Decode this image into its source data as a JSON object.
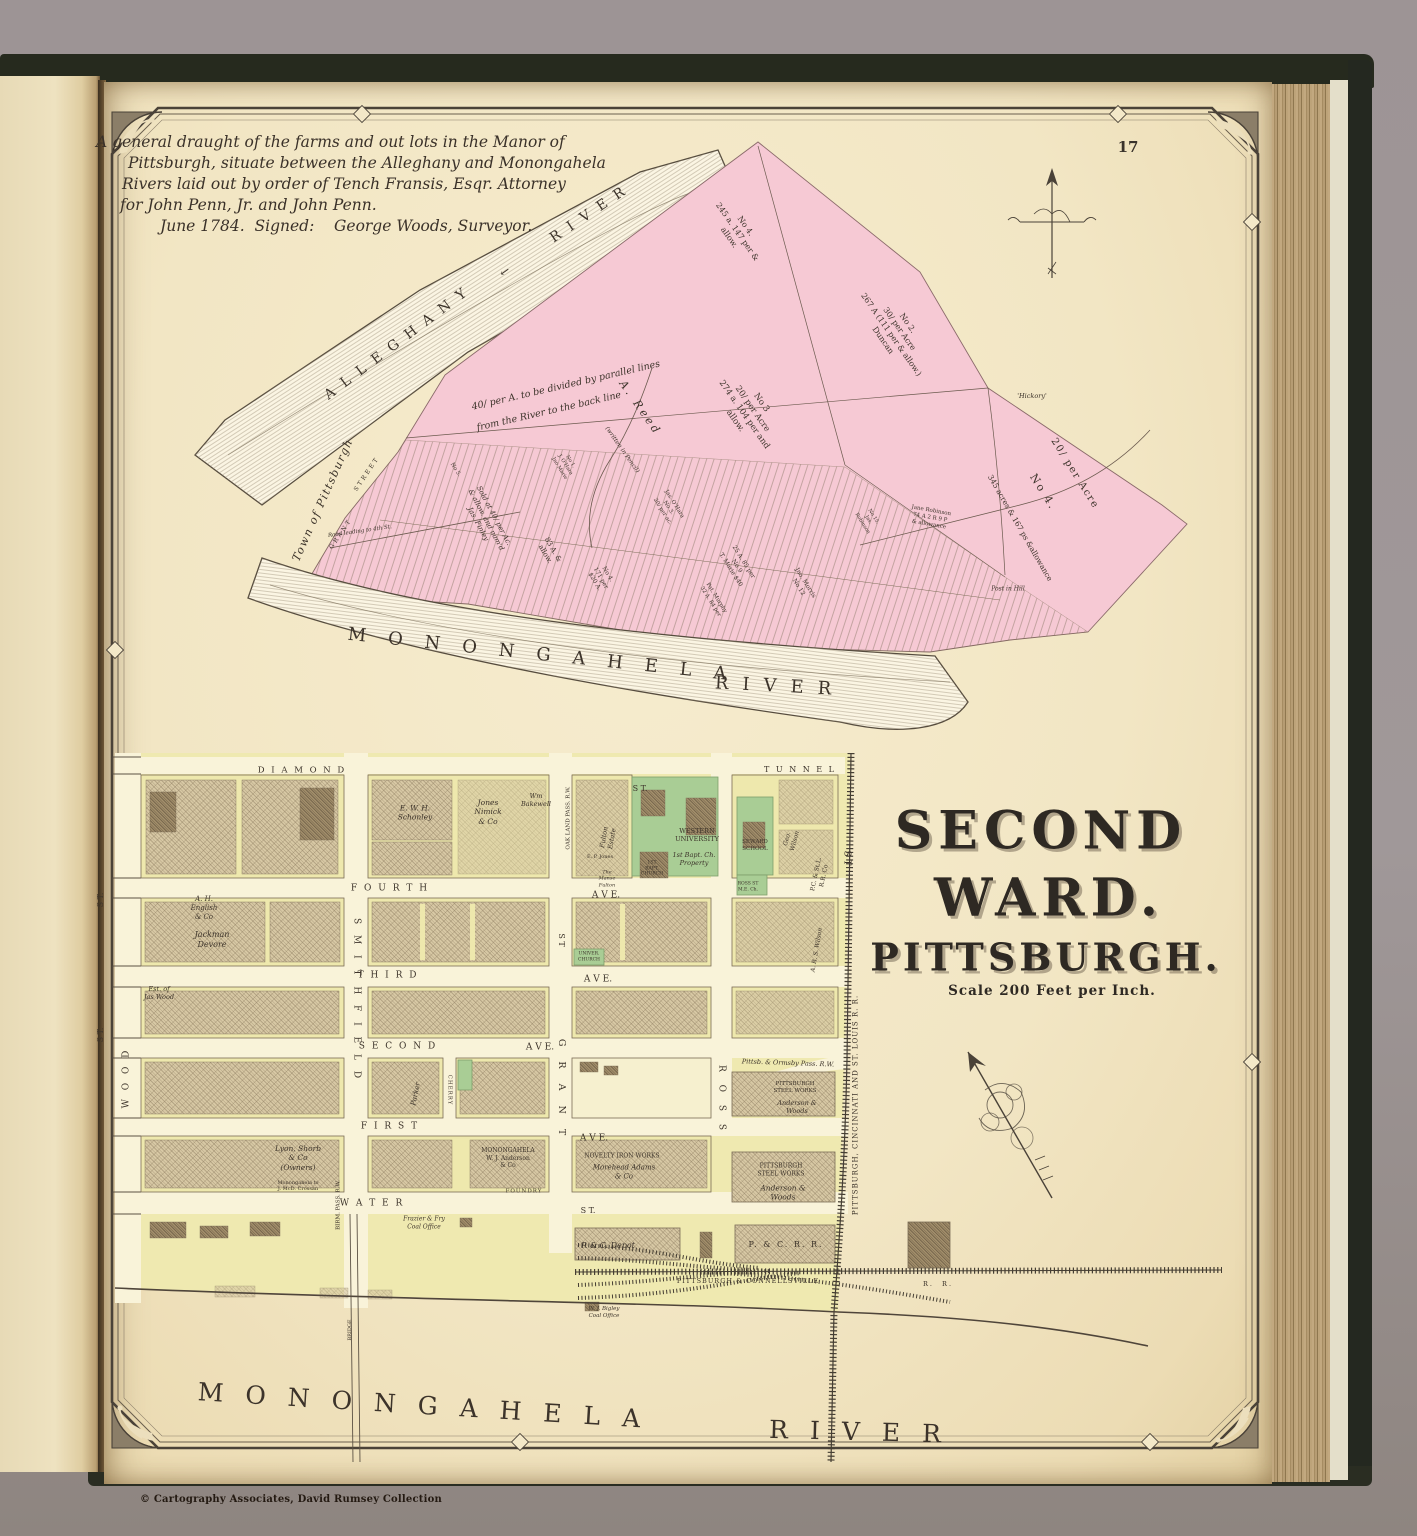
{
  "page": {
    "number": "17",
    "copyright": "© Cartography Associates, David Rumsey Collection"
  },
  "palette": {
    "manor_pink": "#f6c9d4",
    "block_yellow": "#efe9b0",
    "school_green": "#a9cd95",
    "paper": "#f2e6c4"
  },
  "upper_map": {
    "title_lines": [
      "A general draught of the farms and out lots in the Manor of",
      "Pittsburgh, situate between the Alleghany and Monongahela",
      "Rivers laid out by order of Tench Fransis, Esqr. Attorney",
      "for John Penn, Jr. and John Penn.",
      "June 1784.  Signed:    George Woods, Surveyor."
    ],
    "labels": [
      {
        "id": "alleghany-name",
        "t": "ALLEGHANY",
        "x": 400,
        "y": 342,
        "r": -37,
        "fs": 14,
        "ls": 10
      },
      {
        "id": "alleghany-river-word",
        "t": "RIVER",
        "x": 592,
        "y": 213,
        "r": -34,
        "fs": 14,
        "ls": 10
      },
      {
        "id": "flow-arrow-icon",
        "t": "←",
        "x": 505,
        "y": 272,
        "r": -36,
        "fs": 12
      },
      {
        "id": "lot-no4-north",
        "t": "No 4.\n245 a. 147 per &\nallow.",
        "x": 737,
        "y": 232,
        "r": 55,
        "fs": 8
      },
      {
        "id": "lot-no2",
        "t": "No 2.\n30/ per Acre\n267 A (111 per & allow.)\nDuncan",
        "x": 895,
        "y": 332,
        "r": 55,
        "fs": 8
      },
      {
        "id": "lot-no3",
        "t": "No 3\n20/ per Acre\n274 a. 104 per and\nallow.",
        "x": 748,
        "y": 412,
        "r": 55,
        "fs": 8.5
      },
      {
        "id": "reed-name",
        "t": "A. Reed",
        "x": 640,
        "y": 408,
        "r": 55,
        "fs": 11,
        "ls": 3,
        "c": "it"
      },
      {
        "id": "pencil-note",
        "t": "(written in Pencil)",
        "x": 622,
        "y": 450,
        "r": 55,
        "fs": 6,
        "c": "it"
      },
      {
        "id": "parallel-note-1",
        "t": "40/ per A. to be divided by parallel lines",
        "x": 566,
        "y": 386,
        "r": -13,
        "fs": 9.5,
        "c": "it"
      },
      {
        "id": "parallel-note-2",
        "t": "from the River to the back line",
        "x": 549,
        "y": 412,
        "r": -13,
        "fs": 9.5,
        "c": "it"
      },
      {
        "id": "town-of-pittsburgh",
        "t": "Town of Pittsburgh",
        "x": 323,
        "y": 500,
        "r": -66,
        "fs": 11,
        "ls": 1.5,
        "c": "it"
      },
      {
        "id": "grant-street-word",
        "t": "STREET",
        "x": 367,
        "y": 474,
        "r": -56,
        "fs": 6,
        "ls": 2.5
      },
      {
        "id": "grant-name",
        "t": "GRANT",
        "x": 341,
        "y": 534,
        "r": -56,
        "fs": 6,
        "ls": 2.5
      },
      {
        "id": "road-to-4th",
        "t": "Road leading to 4th St.",
        "x": 360,
        "y": 532,
        "r": -8,
        "fs": 5.5,
        "c": "it"
      },
      {
        "id": "sold-note",
        "t": "Sold at 40/ per Ac.\n& allow. and nam'd\nJas. Finley",
        "x": 486,
        "y": 520,
        "r": 62,
        "fs": 7,
        "c": "it"
      },
      {
        "id": "lot-83a",
        "t": "83 A. &\nallow.",
        "x": 549,
        "y": 552,
        "r": 60,
        "fs": 7
      },
      {
        "id": "lot-171per",
        "t": "No 4.\n171 per\n$20 A.",
        "x": 601,
        "y": 578,
        "r": 60,
        "fs": 6
      },
      {
        "id": "lot-no1-ohara",
        "t": "No 1.\nJ. O'Hara\nJno Marie",
        "x": 565,
        "y": 465,
        "r": 58,
        "fs": 5
      },
      {
        "id": "lot-no5",
        "t": "No 5.",
        "x": 455,
        "y": 470,
        "r": 58,
        "fs": 5.5
      },
      {
        "id": "lot-ohara",
        "t": "Jas. O'Hara\nNo 3.\n20/ per ac.",
        "x": 668,
        "y": 508,
        "r": 58,
        "fs": 5.5
      },
      {
        "id": "lot-marie",
        "t": "25 A. 85 per\nNo 9\nT. Marie $40",
        "x": 737,
        "y": 566,
        "r": 58,
        "fs": 6
      },
      {
        "id": "lot-morris",
        "t": "Jno. Morris\nNo 12",
        "x": 802,
        "y": 585,
        "r": 58,
        "fs": 6
      },
      {
        "id": "lot-murphy",
        "t": "Pat. Murphy\n32 A. 84 per",
        "x": 713,
        "y": 600,
        "r": 58,
        "fs": 5.5
      },
      {
        "id": "lot-no15",
        "t": "No 15.\nJas.\nRobinson",
        "x": 868,
        "y": 520,
        "r": 58,
        "fs": 5
      },
      {
        "id": "lot-jane-robinson",
        "t": "Jane Robinson\n74 A 2 R 9 P\n& allowance",
        "x": 930,
        "y": 518,
        "r": 10,
        "fs": 5.5
      },
      {
        "id": "post-in-hill",
        "t": "Post in Hill",
        "x": 1008,
        "y": 589,
        "fs": 6,
        "c": "it"
      },
      {
        "id": "hickory",
        "t": "'Hickory'",
        "x": 1032,
        "y": 396,
        "fs": 6.5,
        "c": "it"
      },
      {
        "id": "lot-no4e-rate",
        "t": "20/ per Acre",
        "x": 1074,
        "y": 474,
        "r": 58,
        "fs": 10,
        "ls": 1.5
      },
      {
        "id": "lot-no4e-no",
        "t": "No 4.",
        "x": 1043,
        "y": 492,
        "r": 58,
        "fs": 11,
        "ls": 2
      },
      {
        "id": "lot-no4e-acres",
        "t": "345 acres & 167 ps &allowance",
        "x": 1020,
        "y": 528,
        "r": 60,
        "fs": 7.5
      },
      {
        "id": "monongahela-upper",
        "t": "MONONGAHELA",
        "x": 548,
        "y": 656,
        "r": 6,
        "fs": 18,
        "ls": 22
      },
      {
        "id": "river-upper",
        "t": "RIVER",
        "x": 780,
        "y": 687,
        "r": 3,
        "fs": 18,
        "ls": 14
      }
    ]
  },
  "lower_map": {
    "title_line1": "SECOND",
    "title_line2": "WARD.",
    "title_line3": "PITTSBURGH.",
    "scale_note": "Scale 200 Feet per Inch.",
    "labels": [
      {
        "id": "street-diamond",
        "t": "D I A M O N D",
        "x": 302,
        "y": 771,
        "fs": 8.5,
        "ls": 2
      },
      {
        "id": "street-diamond-st",
        "t": "S T.",
        "x": 640,
        "y": 789,
        "fs": 8
      },
      {
        "id": "street-fourth",
        "t": "F O U R T H",
        "x": 390,
        "y": 889,
        "fs": 9,
        "ls": 2
      },
      {
        "id": "street-fourth-ave",
        "t": "A V E.",
        "x": 606,
        "y": 896,
        "fs": 9
      },
      {
        "id": "street-third",
        "t": "T H I R D",
        "x": 388,
        "y": 976,
        "fs": 9,
        "ls": 2
      },
      {
        "id": "street-third-ave",
        "t": "A V E.",
        "x": 598,
        "y": 980,
        "fs": 9
      },
      {
        "id": "street-second",
        "t": "S E C O N D",
        "x": 398,
        "y": 1047,
        "fs": 9,
        "ls": 2
      },
      {
        "id": "street-second-ave",
        "t": "A V E.",
        "x": 540,
        "y": 1048,
        "fs": 9
      },
      {
        "id": "street-first",
        "t": "F I R S T",
        "x": 390,
        "y": 1127,
        "fs": 9,
        "ls": 2
      },
      {
        "id": "street-first-ave",
        "t": "A V E.",
        "x": 594,
        "y": 1139,
        "fs": 9
      },
      {
        "id": "street-water",
        "t": "W A T E R",
        "x": 372,
        "y": 1204,
        "fs": 9,
        "ls": 2
      },
      {
        "id": "street-water-st",
        "t": "S T.",
        "x": 588,
        "y": 1211,
        "fs": 8
      },
      {
        "id": "street-wood",
        "t": "W O O D",
        "x": 127,
        "y": 1078,
        "r": -90,
        "fs": 9,
        "ls": 3
      },
      {
        "id": "street-wood-st",
        "t": "S T.",
        "x": 101,
        "y": 900,
        "r": -90,
        "fs": 8
      },
      {
        "id": "street-st-left",
        "t": "S T.",
        "x": 101,
        "y": 1035,
        "r": -90,
        "fs": 8
      },
      {
        "id": "street-smithfield",
        "t": "S M I T H F I E L D",
        "x": 356,
        "y": 1000,
        "r": 90,
        "fs": 9,
        "ls": 4
      },
      {
        "id": "street-grant",
        "t": "G R A N T",
        "x": 561,
        "y": 1090,
        "r": 90,
        "fs": 9.5,
        "ls": 6
      },
      {
        "id": "street-grant-st",
        "t": "S T",
        "x": 561,
        "y": 940,
        "r": 90,
        "fs": 8
      },
      {
        "id": "street-cherry",
        "t": "CHERRY",
        "x": 449,
        "y": 1090,
        "r": 90,
        "fs": 5.5,
        "ls": 1
      },
      {
        "id": "street-ross",
        "t": "R O S S",
        "x": 721,
        "y": 1100,
        "r": 90,
        "fs": 9,
        "ls": 5
      },
      {
        "id": "street-tunnel",
        "t": "T U N N E L",
        "x": 800,
        "y": 770,
        "fs": 8,
        "ls": 2
      },
      {
        "id": "street-st-rr",
        "t": "S T",
        "x": 846,
        "y": 858,
        "r": 90,
        "fs": 9
      },
      {
        "id": "rr-pcsl",
        "t": "PITTSBURGH, CINCINNATI AND ST. LOUIS R. R.",
        "x": 856,
        "y": 1105,
        "r": -90,
        "fs": 7,
        "ls": 1
      },
      {
        "id": "rr-pc-connellsville",
        "t": "PITTSBURGH & CONNELLSVILLE",
        "x": 748,
        "y": 1281,
        "fs": 6.5,
        "ls": 1
      },
      {
        "id": "rr-pc-rr",
        "t": "R.  R.",
        "x": 938,
        "y": 1284,
        "fs": 6.5,
        "ls": 2
      },
      {
        "id": "rr-birm-pass",
        "t": "BIRM. PASS. R.W.",
        "x": 339,
        "y": 1205,
        "r": -90,
        "fs": 5.5
      },
      {
        "id": "rr-oakland-pass",
        "t": "OAK LAND PASS. R.W.",
        "x": 569,
        "y": 818,
        "r": -90,
        "fs": 5.5
      },
      {
        "id": "rr-ormsby-pass",
        "t": "Pittsb. & Ormsby Pass. R.W.",
        "x": 788,
        "y": 1063,
        "r": 2,
        "fs": 6.5,
        "c": "it"
      },
      {
        "id": "rr-pcsl-co",
        "t": "P.C. & St.L.\nR.R. Co",
        "x": 820,
        "y": 875,
        "r": -78,
        "fs": 6
      },
      {
        "id": "owner-schonley",
        "t": "E. W. H.\nSchonley",
        "x": 415,
        "y": 813,
        "fs": 7.5,
        "c": "it"
      },
      {
        "id": "owner-nimick",
        "t": "Jones\nNimick\n& Co",
        "x": 488,
        "y": 812,
        "fs": 7.5,
        "c": "it"
      },
      {
        "id": "owner-bakewell",
        "t": "Wm\nBakewell",
        "x": 536,
        "y": 800,
        "fs": 6.5,
        "c": "it"
      },
      {
        "id": "owner-fulton-estate",
        "t": "Fulton\nEstate",
        "x": 608,
        "y": 838,
        "r": -80,
        "fs": 6.5,
        "c": "it"
      },
      {
        "id": "owner-ep-jones",
        "t": "E. P. Jones",
        "x": 600,
        "y": 857,
        "fs": 5
      },
      {
        "id": "owner-manse-fulton",
        "t": "The\nManse\nFulton",
        "x": 607,
        "y": 879,
        "fs": 5,
        "c": "it"
      },
      {
        "id": "western-university",
        "t": "WESTERN\nUNIVERSITY",
        "x": 697,
        "y": 835,
        "fs": 6.5
      },
      {
        "id": "bapt-property",
        "t": "1st Bapt. Ch.\nProperty",
        "x": 694,
        "y": 859,
        "fs": 6.5,
        "c": "it"
      },
      {
        "id": "bapt-church",
        "t": "1ST\nBAPT.\nCHURCH",
        "x": 652,
        "y": 869,
        "fs": 4.6
      },
      {
        "id": "seward-school",
        "t": "SEWARD\nSCHOOL",
        "x": 755,
        "y": 846,
        "fs": 5.5
      },
      {
        "id": "ross-st-me-church",
        "t": "ROSS ST\nM.E. Ch.",
        "x": 748,
        "y": 887,
        "fs": 4.5
      },
      {
        "id": "owner-geo-wilson",
        "t": "Geo.\nWilson",
        "x": 791,
        "y": 840,
        "r": -75,
        "fs": 6,
        "c": "it"
      },
      {
        "id": "owner-english",
        "t": "A. H.\nEnglish\n& Co",
        "x": 204,
        "y": 908,
        "fs": 7,
        "c": "it"
      },
      {
        "id": "owner-jackman-devore",
        "t": "Jackman\nDevore",
        "x": 212,
        "y": 940,
        "fs": 8,
        "c": "it"
      },
      {
        "id": "owner-jas-wood",
        "t": "Est. of\nJas Wood",
        "x": 159,
        "y": 993,
        "fs": 6.5,
        "c": "it"
      },
      {
        "id": "univer-church",
        "t": "UNIVER.\nCHURCH",
        "x": 589,
        "y": 957,
        "fs": 4.5
      },
      {
        "id": "owner-ars-wilson",
        "t": "A. R. S. Wilson",
        "x": 817,
        "y": 950,
        "r": -80,
        "fs": 6,
        "c": "it"
      },
      {
        "id": "owner-parker",
        "t": "Parker",
        "x": 416,
        "y": 1094,
        "r": -78,
        "fs": 7,
        "c": "it"
      },
      {
        "id": "owner-lyon-shorb",
        "t": "Lyon, Shorb\n& Co\n(Owners)",
        "x": 298,
        "y": 1158,
        "fs": 7.5,
        "c": "it"
      },
      {
        "id": "owner-crossan",
        "t": "Monongahela to\nJ. McD. Crossan",
        "x": 298,
        "y": 1186,
        "fs": 5
      },
      {
        "id": "anderson-foundry",
        "t": "MONONGAHELA\nW. J. Anderson\n& Co",
        "x": 508,
        "y": 1158,
        "fs": 6
      },
      {
        "id": "foundry-word",
        "t": "FOUNDRY",
        "x": 524,
        "y": 1192,
        "fs": 5.5,
        "ls": 1
      },
      {
        "id": "novelty-iron-works",
        "t": "NOVELTY IRON WORKS",
        "x": 622,
        "y": 1156,
        "fs": 6
      },
      {
        "id": "morehead-adams",
        "t": "Morehead Adams\n& Co",
        "x": 624,
        "y": 1172,
        "fs": 7,
        "c": "it"
      },
      {
        "id": "steel-works-upper",
        "t": "PITTSBURGH\nSTEEL WORKS",
        "x": 795,
        "y": 1088,
        "fs": 5.5
      },
      {
        "id": "steel-works-upper-owner",
        "t": "Anderson &\nWoods",
        "x": 797,
        "y": 1107,
        "fs": 6.5,
        "c": "it"
      },
      {
        "id": "steel-works-lower",
        "t": "PITTSBURGH\nSTEEL WORKS",
        "x": 781,
        "y": 1170,
        "fs": 6
      },
      {
        "id": "steel-works-lower-owner",
        "t": "Anderson &\nWoods",
        "x": 783,
        "y": 1193,
        "fs": 7.5,
        "c": "it"
      },
      {
        "id": "pc-depot",
        "t": "P. & C. Depot",
        "x": 608,
        "y": 1246,
        "fs": 8,
        "c": "it"
      },
      {
        "id": "pc-rr-building",
        "t": "P. & C. R. R.",
        "x": 786,
        "y": 1245,
        "fs": 8,
        "ls": 2
      },
      {
        "id": "bigley-coal",
        "t": "W. J. Bigley\nCoal Office",
        "x": 604,
        "y": 1313,
        "fs": 5.5,
        "c": "it"
      },
      {
        "id": "frazier-coal",
        "t": "Frazier & Fry\nCoal Office",
        "x": 424,
        "y": 1223,
        "fs": 6,
        "c": "it"
      },
      {
        "id": "bridge-note",
        "t": "BRIDGE",
        "x": 350,
        "y": 1330,
        "r": -90,
        "fs": 5
      },
      {
        "id": "monongahela-lower",
        "t": "MONONGAHELA",
        "x": 430,
        "y": 1406,
        "r": 3.5,
        "fs": 25,
        "ls": 22
      },
      {
        "id": "river-lower",
        "t": "RIVER",
        "x": 866,
        "y": 1432,
        "r": 1.5,
        "fs": 25,
        "ls": 22
      }
    ]
  }
}
